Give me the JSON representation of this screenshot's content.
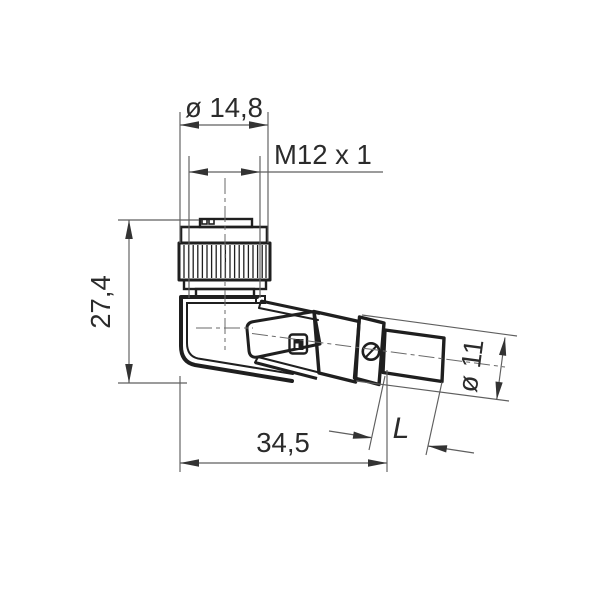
{
  "page": {
    "background": "#ffffff"
  },
  "drawing": {
    "type": "technical-dimension-drawing",
    "subject": "right-angle circular connector with cable outlet",
    "colors": {
      "part_outline": "#1f1f1f",
      "dimension_lines": "#5f5f5f",
      "text": "#2b2b2b",
      "background": "#ffffff"
    },
    "labels": {
      "knurl_diameter": "ø 14,8",
      "thread_spec": "M12 x 1",
      "overall_height": "27,4",
      "overall_length": "34,5",
      "cable_free_length": "L",
      "body_diameter": "ø 11"
    }
  }
}
